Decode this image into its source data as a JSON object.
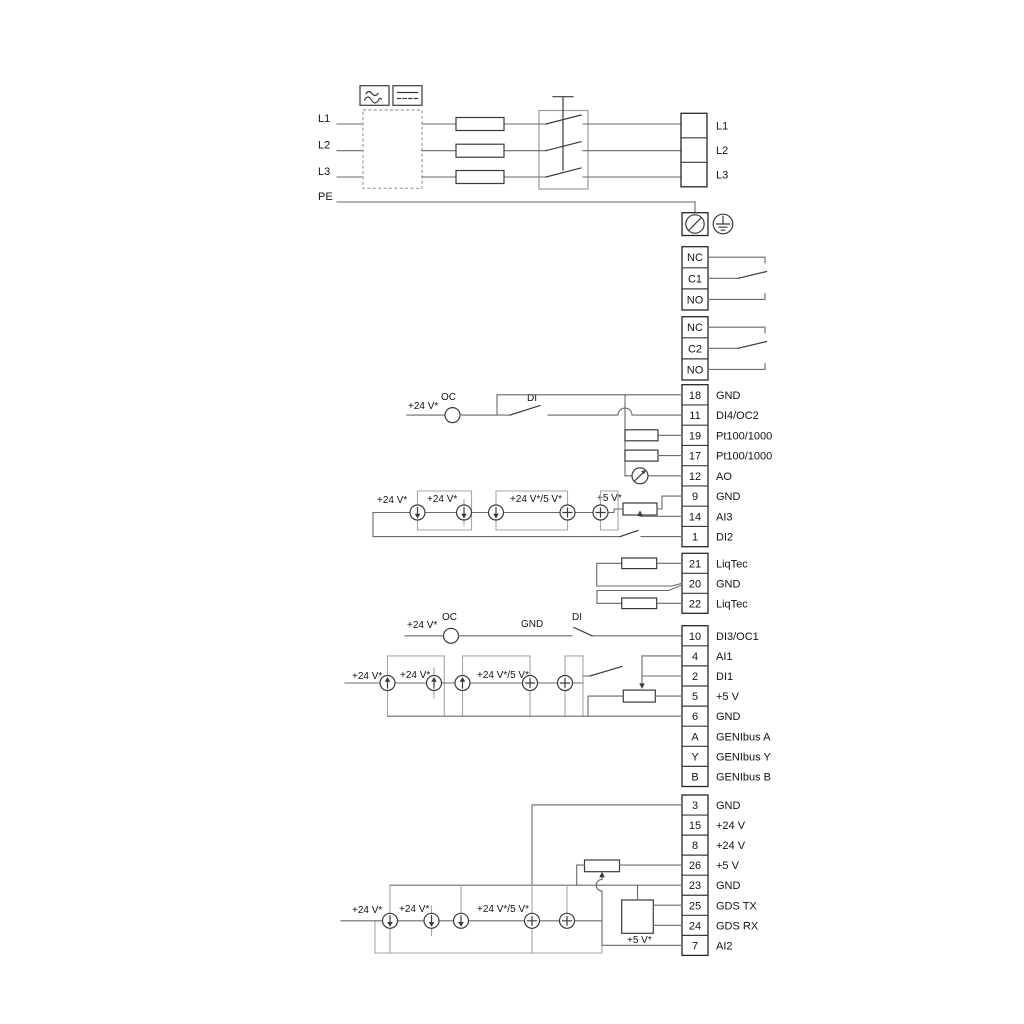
{
  "sym": {
    "v24": "+24 V*",
    "v24_5": "+24 V*/5 V*",
    "v5": "+5 V*",
    "oc": "OC",
    "di": "DI",
    "gnd": "GND"
  },
  "power": {
    "inputs": [
      "L1",
      "L2",
      "L3",
      "PE"
    ],
    "outputs": [
      "L1",
      "L2",
      "L3"
    ]
  },
  "relays": {
    "r1": [
      "NC",
      "C1",
      "NO"
    ],
    "r2": [
      "NC",
      "C2",
      "NO"
    ]
  },
  "blockA": {
    "rows": [
      {
        "num": "18",
        "label": "GND"
      },
      {
        "num": "11",
        "label": "DI4/OC2"
      },
      {
        "num": "19",
        "label": "Pt100/1000"
      },
      {
        "num": "17",
        "label": "Pt100/1000"
      },
      {
        "num": "12",
        "label": "AO"
      },
      {
        "num": "9",
        "label": "GND"
      },
      {
        "num": "14",
        "label": "AI3"
      },
      {
        "num": "1",
        "label": "DI2"
      }
    ]
  },
  "liqtec": {
    "rows": [
      {
        "num": "21",
        "label": "LiqTec"
      },
      {
        "num": "20",
        "label": "GND"
      },
      {
        "num": "22",
        "label": "LiqTec"
      }
    ]
  },
  "blockB": {
    "rows": [
      {
        "num": "10",
        "label": "DI3/OC1"
      },
      {
        "num": "4",
        "label": "AI1"
      },
      {
        "num": "2",
        "label": "DI1"
      },
      {
        "num": "5",
        "label": "+5 V"
      },
      {
        "num": "6",
        "label": "GND"
      },
      {
        "num": "A",
        "label": "GENIbus A"
      },
      {
        "num": "Y",
        "label": "GENIbus Y"
      },
      {
        "num": "B",
        "label": "GENIbus B"
      }
    ]
  },
  "blockC": {
    "rows": [
      {
        "num": "3",
        "label": "GND"
      },
      {
        "num": "15",
        "label": "+24 V"
      },
      {
        "num": "8",
        "label": "+24 V"
      },
      {
        "num": "26",
        "label": "+5 V"
      },
      {
        "num": "23",
        "label": "GND"
      },
      {
        "num": "25",
        "label": "GDS TX"
      },
      {
        "num": "24",
        "label": "GDS RX"
      },
      {
        "num": "7",
        "label": "AI2"
      }
    ]
  }
}
